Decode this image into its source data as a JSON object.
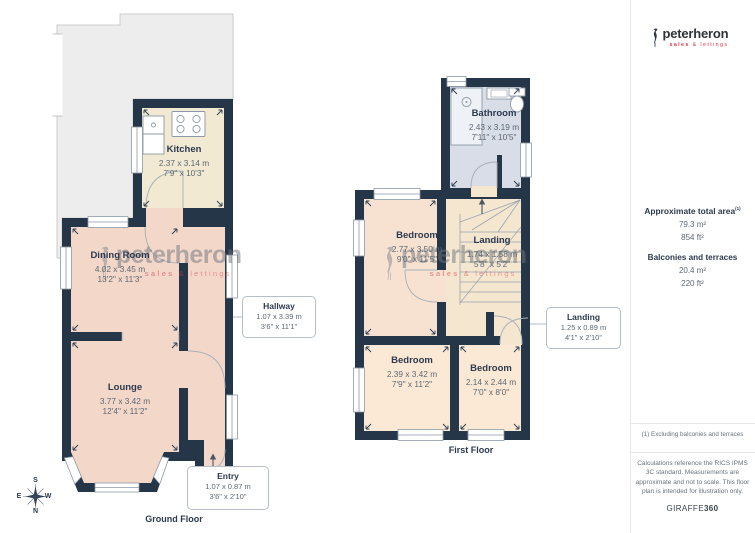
{
  "brand": {
    "name": "peterheron",
    "tagline_sales": "sales",
    "tagline_rest": " & lettings"
  },
  "sidebar": {
    "total_area_label": "Approximate total area",
    "total_area_sup": "(1)",
    "total_area_metric": "79.3 m²",
    "total_area_imperial": "854 ft²",
    "balconies_label": "Balconies and terraces",
    "balconies_metric": "20.4 m²",
    "balconies_imperial": "220 ft²",
    "footnote": "(1) Excluding balconies and terraces",
    "disclaimer": "Calculations reference the RICS IPMS 3C standard. Measurements are approximate and not to scale. This floor plan is intended for illustration only.",
    "maker": "GIRAFFE",
    "maker_suffix": "360"
  },
  "ground_floor": {
    "label": "Ground Floor",
    "kitchen": {
      "name": "Kitchen",
      "metric": "2.37 x 3.14 m",
      "imperial": "7'9\" x 10'3\""
    },
    "dining": {
      "name": "Dining Room",
      "metric": "4.02 x 3.45 m",
      "imperial": "13'2\" x 11'3\""
    },
    "hallway": {
      "name": "Hallway",
      "metric": "1.07 x 3.39 m",
      "imperial": "3'6\" x 11'1\""
    },
    "lounge": {
      "name": "Lounge",
      "metric": "3.77 x 3.42 m",
      "imperial": "12'4\" x 11'2\""
    },
    "entry": {
      "name": "Entry",
      "metric": "1.07 x 0.87 m",
      "imperial": "3'6\" x 2'10\""
    }
  },
  "first_floor": {
    "label": "First Floor",
    "bathroom": {
      "name": "Bathroom",
      "metric": "2.43 x 3.19 m",
      "imperial": "7'11\" x 10'5\""
    },
    "bedroom_front": {
      "name": "Bedroom",
      "metric": "2.77 x 3.50 m",
      "imperial": "9'0\" x 11'5\""
    },
    "landing": {
      "name": "Landing",
      "metric": "1.74 x 1.58 m",
      "imperial": "5'8\" x 5'2\""
    },
    "bedroom_left": {
      "name": "Bedroom",
      "metric": "2.39 x 3.42 m",
      "imperial": "7'9\" x 11'2\""
    },
    "bedroom_right": {
      "name": "Bedroom",
      "metric": "2.14 x 2.44 m",
      "imperial": "7'0\" x 8'0\""
    },
    "landing_small": {
      "name": "Landing",
      "metric": "1.25 x 0.89 m",
      "imperial": "4'1\" x 2'10\""
    }
  },
  "compass": {
    "top": "S",
    "bottom": "N",
    "left": "E",
    "right": "W"
  },
  "colors": {
    "wall": "#253649",
    "room_pink": "#f3d8ca",
    "room_cream": "#f1e9d2",
    "room_peach": "#fbe9d5",
    "bathroom_blue": "#d8dde7",
    "landing_beige": "#f5e6d0",
    "terrace_grey": "#ededed",
    "accent_red": "#e0344a"
  }
}
